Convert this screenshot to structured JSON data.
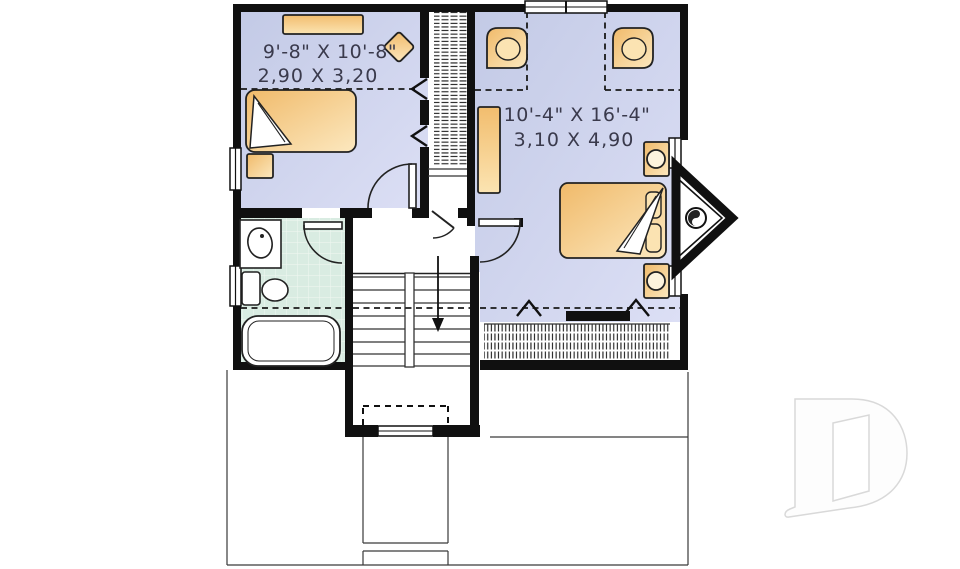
{
  "page": {
    "type": "architectural floor plan, upper level",
    "background": "#ffffff"
  },
  "rooms": {
    "bedroom1": {
      "dim_imperial": "9'-8\" X 10'-8\"",
      "dim_metric": "2,90 X 3,20"
    },
    "bedroom2": {
      "dim_imperial": "10'-4\" X 16'-4\"",
      "dim_metric": "3,10 X 4,90"
    }
  },
  "palette": {
    "floor_blue_dark": "#c3cae6",
    "floor_blue_light": "#dcdff5",
    "bath_tile_green": "#d9ece2",
    "furniture_tan_dark": "#f0ba6a",
    "furniture_tan_light": "#fce8bf",
    "wall_black": "#101010",
    "dimension_text": "#3a3a4c",
    "logo_outline_gray": "#d9d9d9"
  },
  "watermark": {
    "name": "D logo (open-door monogram)"
  }
}
